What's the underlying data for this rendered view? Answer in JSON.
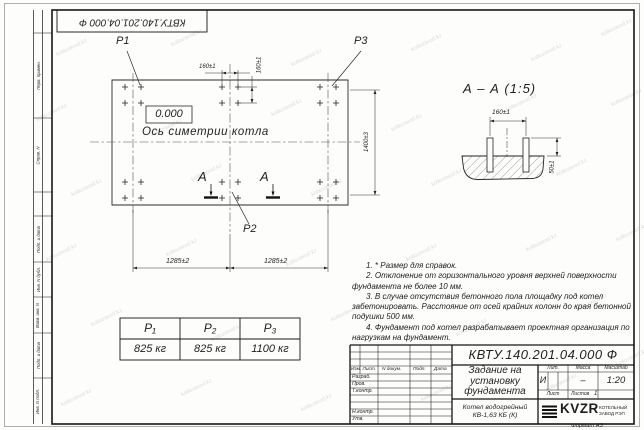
{
  "sheet": {
    "doc_number_stamp": "КВТУ.140.201.04.000  Ф",
    "format_label": "Формат А3",
    "watermark_text": "kotlozavod.kz"
  },
  "margin_labels": [
    "Перв. примен.",
    "Справ. N",
    "Подп. и дата",
    "Инв. N дубл.",
    "Взам. инв. N",
    "Подп. и дата",
    "Инв. N подл."
  ],
  "plan": {
    "load_label_p1": "P1",
    "load_label_p2": "P2",
    "load_label_p3": "P3",
    "level_mark": "0.000",
    "axis_label": "Ось симетрии котла",
    "section_letter_left": "А",
    "section_letter_right": "А",
    "dim_160_h": "160±1",
    "dim_160_v": "160±1",
    "dim_1285_left": "1285±2",
    "dim_1285_right": "1285±2",
    "dim_1400": "1400±3"
  },
  "section_view": {
    "title": "А – А (1:5)",
    "dim_160": "160±1",
    "dim_50": "50±1"
  },
  "notes": [
    "1. * Размер для справок.",
    "2. Отклонение от горизонтального уровня верхней поверхности фундамента не более 10 мм.",
    "3. В случае отсутствия бетонного пола площадку под котел забетонировать. Расстояние от осей крайних колонн до края бетонной подушки 500 мм.",
    "4. Фундамент под котел разрабатывает проектная организация по нагрузкам на фундамент."
  ],
  "load_table": {
    "headers": [
      "P₁",
      "P₂",
      "P₃"
    ],
    "values": [
      "825 кг",
      "825 кг",
      "1100 кг"
    ]
  },
  "title_block": {
    "doc_number": "КВТУ.140.201.04.000  Ф",
    "title": "Задание на\nустановку\nфундамента",
    "product": "Котел водогрейный\nКВ-1,63 КБ  (К)",
    "col_izm": "Изм. Лист",
    "col_doc": "N докум.",
    "col_sign": "Подп.",
    "col_date": "Дата",
    "row_developed": "Разраб.",
    "row_checked": "Пров.",
    "row_tcontrol": "Т.контр.",
    "row_ncontrol": "Н.контр.",
    "row_approved": "Утв.",
    "lit_label": "Лит.",
    "mass_label": "Масса",
    "scale_label": "Масштаб",
    "lit_value": "И",
    "mass_value": "–",
    "scale_value": "1:20",
    "sheet_label": "Лист",
    "sheets_label": "Листов",
    "sheets_value": "1",
    "logo_text": "KVZR",
    "org_name": "КОТЕЛЬНЫЙ\nЗАВОД РЭП"
  },
  "watermarks": [
    [
      55,
      45
    ],
    [
      170,
      35
    ],
    [
      290,
      55
    ],
    [
      410,
      40
    ],
    [
      530,
      50
    ],
    [
      600,
      25
    ],
    [
      35,
      110
    ],
    [
      150,
      125
    ],
    [
      270,
      105
    ],
    [
      390,
      120
    ],
    [
      505,
      100
    ],
    [
      610,
      95
    ],
    [
      70,
      185
    ],
    [
      190,
      170
    ],
    [
      310,
      185
    ],
    [
      430,
      175
    ],
    [
      555,
      165
    ],
    [
      45,
      250
    ],
    [
      165,
      245
    ],
    [
      285,
      255
    ],
    [
      405,
      250
    ],
    [
      525,
      240
    ],
    [
      615,
      230
    ],
    [
      90,
      315
    ],
    [
      210,
      330
    ],
    [
      330,
      310
    ],
    [
      455,
      325
    ],
    [
      575,
      300
    ],
    [
      60,
      395
    ],
    [
      180,
      385
    ],
    [
      300,
      400
    ],
    [
      420,
      390
    ],
    [
      545,
      380
    ],
    [
      615,
      355
    ]
  ]
}
